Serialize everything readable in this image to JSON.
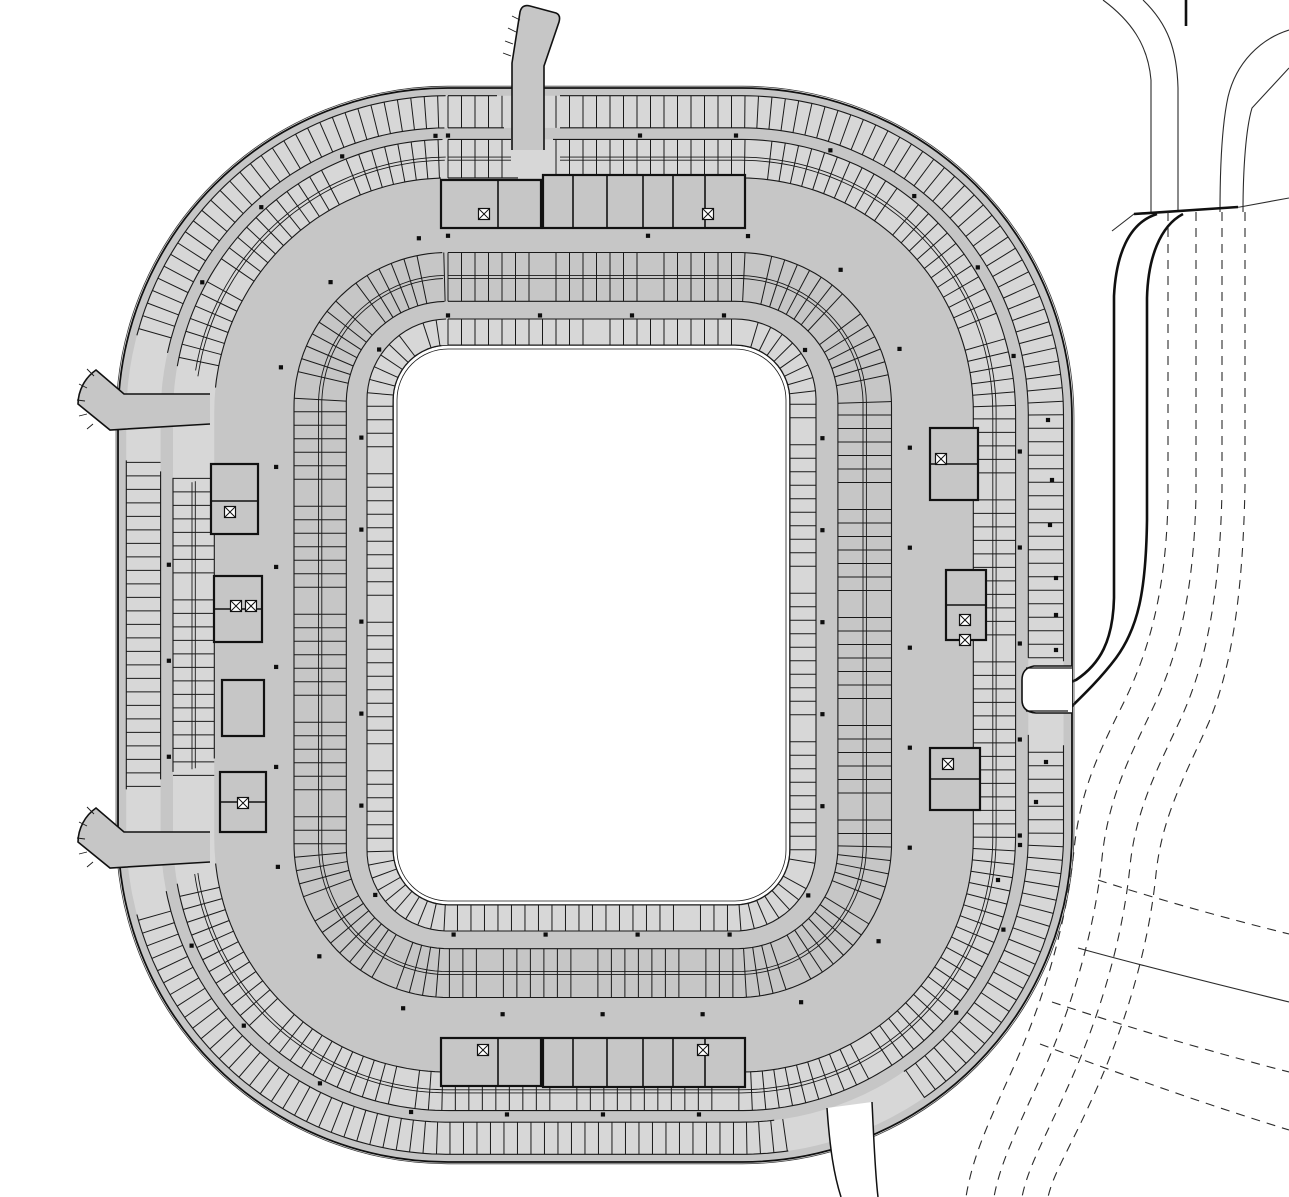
{
  "meta": {
    "drawing_name": "stadium-parking-level-floor-plan"
  },
  "canvas": {
    "w": 1289,
    "h": 1197,
    "bg": "#ffffff"
  },
  "colors": {
    "floor": "#c6c6c6",
    "band_fill": "#d7d7d7",
    "line": "#1a1a1a",
    "edge": "#111111",
    "thin": "#2b2b2b",
    "road": "#101010",
    "white": "#ffffff",
    "dot": "#0d0d0d"
  },
  "stadium": {
    "center": [
      591,
      625
    ],
    "outer": {
      "x": 118,
      "y": 88,
      "w": 954,
      "h": 1074,
      "r": 330
    },
    "void": {
      "x": 393,
      "y": 345,
      "w": 397,
      "h": 560,
      "r": 55
    },
    "void_inner_inset": 4
  },
  "bands": [
    {
      "name": "outer-stall-ring",
      "t0": 0.03,
      "t1": 0.155,
      "row": "single",
      "spacing": 13.5,
      "fill": true,
      "segment": null,
      "gaps": [
        [
          -99.5,
          -94
        ],
        [
          -160,
          -148
        ],
        [
          148,
          160
        ],
        [
          55,
          69
        ],
        [
          5,
          14
        ]
      ]
    },
    {
      "name": "second-stall-ring",
      "t0": 0.2,
      "t1": 0.35,
      "row": "double",
      "spacing": 13.5,
      "fill": true,
      "segment": {
        "period": 160,
        "gap": 10
      },
      "gaps": [
        [
          -99,
          -94.5
        ],
        [
          -160,
          -148
        ],
        [
          148,
          160
        ]
      ]
    },
    {
      "name": "third-stall-ring",
      "t0": 0.64,
      "t1": 0.83,
      "row": "double",
      "spacing": 13.5,
      "fill": false,
      "segment": {
        "period": 105,
        "gap": 15
      },
      "gaps": []
    }
  ],
  "inner_ring": {
    "name": "void-stall-ring",
    "outset": 26,
    "spacing": 13.5,
    "fill": true,
    "segment": {
      "period": 150,
      "gap": 12
    },
    "gaps": []
  },
  "dot_rings": [
    {
      "t": 0.185,
      "spacing": 96,
      "gaps": [
        [
          -99.5,
          -94
        ],
        [
          -160,
          -148
        ],
        [
          148,
          160
        ],
        [
          55,
          69
        ],
        [
          5,
          14
        ]
      ]
    },
    {
      "t": 0.575,
      "spacing": 100,
      "gaps": [
        [
          -99,
          -94.5
        ]
      ]
    },
    {
      "t": 0.885,
      "spacing": 92,
      "gaps": []
    }
  ],
  "extra_dots": [
    [
      1056,
      578
    ],
    [
      1056,
      615
    ],
    [
      1056,
      650
    ],
    [
      1048,
      420
    ],
    [
      1052,
      480
    ],
    [
      1050,
      525
    ],
    [
      1046,
      762
    ],
    [
      1036,
      802
    ],
    [
      1020,
      845
    ],
    [
      998,
      880
    ]
  ],
  "cores": [
    {
      "x": 441,
      "y": 180,
      "w": 100,
      "h": 48,
      "walls": [
        "M498,180 L498,228"
      ]
    },
    {
      "x": 543,
      "y": 175,
      "w": 202,
      "h": 53,
      "walls": [
        "M573,175 L573,228",
        "M607,175 L607,228",
        "M643,175 L643,228",
        "M673,175 L673,228",
        "M705,175 L705,228"
      ]
    },
    {
      "x": 441,
      "y": 1038,
      "w": 100,
      "h": 48,
      "walls": [
        "M498,1038 L498,1086"
      ]
    },
    {
      "x": 543,
      "y": 1038,
      "w": 202,
      "h": 49,
      "walls": [
        "M573,1038 L573,1087",
        "M607,1038 L607,1087",
        "M643,1038 L643,1087",
        "M673,1038 L673,1087",
        "M705,1038 L705,1087"
      ]
    },
    {
      "x": 211,
      "y": 464,
      "w": 47,
      "h": 70,
      "walls": [
        "M211,501 L258,501"
      ]
    },
    {
      "x": 214,
      "y": 576,
      "w": 48,
      "h": 66,
      "walls": [
        "M214,609 L262,609"
      ]
    },
    {
      "x": 222,
      "y": 680,
      "w": 42,
      "h": 56,
      "walls": []
    },
    {
      "x": 220,
      "y": 772,
      "w": 46,
      "h": 60,
      "walls": [
        "M220,802 L266,802"
      ]
    },
    {
      "x": 930,
      "y": 428,
      "w": 48,
      "h": 72,
      "walls": [
        "M930,464 L978,464"
      ]
    },
    {
      "x": 946,
      "y": 570,
      "w": 40,
      "h": 70,
      "walls": [
        "M946,605 L986,605"
      ]
    },
    {
      "x": 930,
      "y": 748,
      "w": 50,
      "h": 62,
      "walls": [
        "M930,779 L980,779"
      ]
    }
  ],
  "stair_symbols": [
    [
      484,
      214
    ],
    [
      708,
      214
    ],
    [
      483,
      1050
    ],
    [
      703,
      1050
    ],
    [
      230,
      512
    ],
    [
      236,
      606
    ],
    [
      251,
      606
    ],
    [
      243,
      803
    ],
    [
      941,
      459
    ],
    [
      965,
      620
    ],
    [
      965,
      640
    ],
    [
      948,
      764
    ]
  ],
  "ramps": [
    {
      "name": "entry-ramp-top",
      "fill": "M512,150 L512,63 L520,12 Q522,4 530,6 L556,13 Q561,15 559,22 L544,66 L544,150 Z",
      "edge": "M512,150 L512,63 L520,12 Q522,4 530,6 L556,13 Q561,15 559,22 L544,66 L544,150"
    },
    {
      "name": "entry-ramp-left-upper",
      "fill": "M210,394 L124,394 L96,370 A42,42 0 0 0 78,404 L110,430 L210,424 Z",
      "edge": "M210,394 L124,394 L96,370 A42,42 0 0 0 78,404 L110,430 L210,424"
    },
    {
      "name": "entry-ramp-left-lower",
      "fill": "M210,832 L124,832 L96,808 A42,42 0 0 0 78,842 L110,868 L210,862 Z",
      "edge": "M210,832 L124,832 L96,808 A42,42 0 0 0 78,842 L110,868 L210,862"
    }
  ],
  "bottom_ramp": {
    "band": "M827,1108 C830,1150 834,1175 841,1197 L878,1197 C875,1172 874,1142 872,1102 Z",
    "curves": [
      "M827,1108 C830,1150 834,1175 841,1197",
      "M872,1102 C874,1142 875,1172 878,1197"
    ]
  },
  "right_notch": {
    "path": "M1072,666 L1034,666 Q1022,668 1022,680 L1022,700 Q1022,712 1036,713 L1072,713",
    "steps": [
      "M1026,668 L1072,668",
      "M1026,711 L1068,711"
    ]
  },
  "roads": {
    "solid": [
      "M1103,0 C1130,20 1148,44 1151,80 L1151,212",
      "M1143,0 C1168,24 1177,50 1178,88 L1178,212",
      "M1289,30 C1260,39 1236,63 1228,97 C1223,120 1220,160 1220,212",
      "M1289,68 L1252,108 C1246,128 1243,168 1243,212",
      "M1112,231 L1134,214 L1240,207 L1289,198",
      "M1078,948 C1150,968 1220,985 1289,1002"
    ],
    "thick": [
      "M1157,214 C1128,223 1116,256 1114,296 L1114,598 C1113,641 1100,664 1076,680 L1058,687",
      "M1183,214 C1160,226 1148,258 1147,298 L1147,520 C1146,592 1138,628 1116,658 C1098,682 1076,702 1066,712 L1058,718",
      "M1134,214 L1238,207",
      "M1186,0 L1186,26"
    ],
    "dashed": [
      "M1168,212 L1168,500 C1166,590 1150,650 1122,706 C1098,754 1080,792 1074,850 C1066,930 1040,1010 1010,1075 C985,1130 972,1160 966,1197",
      "M1196,212 L1196,495 C1194,588 1180,652 1152,710 C1128,760 1108,800 1102,858 C1094,938 1068,1018 1038,1083 C1013,1138 1000,1165 994,1197",
      "M1222,212 L1222,490 C1220,588 1208,658 1182,716 C1158,768 1136,808 1130,866 C1122,946 1096,1026 1066,1091 C1041,1146 1028,1168 1022,1197",
      "M1245,212 L1245,486 C1243,588 1233,664 1209,722 C1185,776 1162,816 1156,874 C1148,954 1122,1034 1092,1099 C1067,1154 1054,1172 1048,1197",
      "M1098,880 C1160,900 1225,918 1289,934",
      "M1052,1002 C1130,1028 1212,1052 1289,1072",
      "M1040,1044 C1120,1074 1205,1104 1289,1130"
    ]
  },
  "hatch_ticks": [
    "M511,56 L503,53",
    "M513,44 L505,41",
    "M516,32 L508,28",
    "M520,20 L512,16",
    "M94,376 L87,369",
    "M87,388 L79,384",
    "M85,401 L77,400",
    "M87,414 L79,416",
    "M93,424 L87,429",
    "M94,814 L87,807",
    "M87,826 L79,822",
    "M85,839 L77,838",
    "M87,852 L79,854",
    "M93,862 L87,867"
  ]
}
